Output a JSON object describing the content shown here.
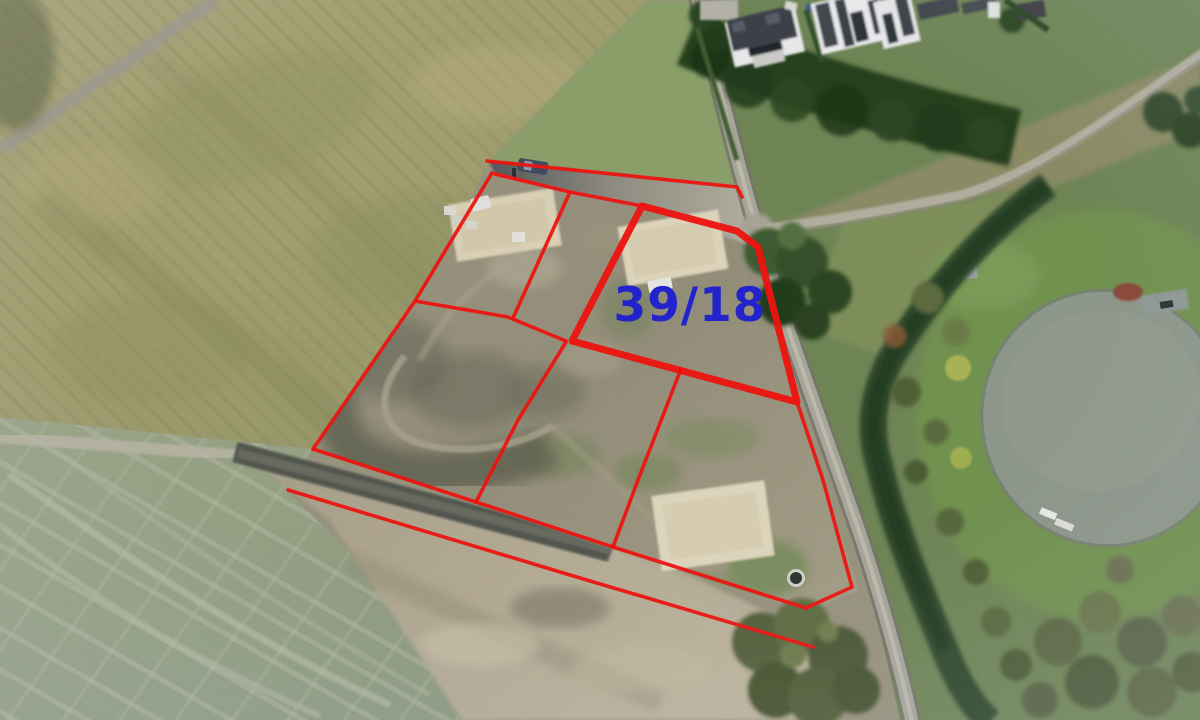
{
  "scene": {
    "kind": "aerial-drone-photo",
    "features": [
      "corn-field",
      "mowed-meadow",
      "building-plots",
      "excavation-pads",
      "access-roads",
      "houses",
      "conifer-row",
      "hedgerow",
      "pond",
      "large-trees",
      "parked-cars",
      "well-ring"
    ]
  },
  "annotation": {
    "parcel_label": "39/18",
    "label_color": "#2323cc",
    "label_center_x": 690,
    "label_center_y": 304,
    "label_font_size": 47,
    "line_color": "#ec1410",
    "thin_line_width": 3.6,
    "thick_line_width": 7,
    "parcel_39_18_outline": [
      [
        642,
        206
      ],
      [
        737,
        231
      ],
      [
        758,
        247
      ],
      [
        797,
        402
      ],
      [
        572,
        341
      ]
    ],
    "boundary_lines": [
      {
        "name": "north-boundary",
        "points": [
          [
            487,
            161
          ],
          [
            737,
            187
          ],
          [
            742,
            197
          ]
        ]
      },
      {
        "name": "west-boundary",
        "points": [
          [
            492,
            173
          ],
          [
            415,
            301
          ],
          [
            313,
            449
          ]
        ]
      },
      {
        "name": "road-south-edge",
        "points": [
          [
            495,
            174
          ],
          [
            570,
            192
          ],
          [
            642,
            206
          ]
        ]
      },
      {
        "name": "upper-divider",
        "points": [
          [
            570,
            192
          ],
          [
            513,
            318
          ]
        ]
      },
      {
        "name": "middle-cross-line",
        "points": [
          [
            415,
            301
          ],
          [
            508,
            317
          ],
          [
            566,
            341
          ]
        ]
      },
      {
        "name": "lower-west-divider",
        "points": [
          [
            566,
            342
          ],
          [
            518,
            420
          ],
          [
            476,
            502
          ]
        ]
      },
      {
        "name": "south-boundary",
        "points": [
          [
            313,
            449
          ],
          [
            476,
            502
          ],
          [
            613,
            547
          ],
          [
            806,
            608
          ]
        ]
      },
      {
        "name": "lower-middle-divider",
        "points": [
          [
            681,
            369
          ],
          [
            638,
            480
          ],
          [
            613,
            547
          ]
        ]
      },
      {
        "name": "east-boundary",
        "points": [
          [
            797,
            402
          ],
          [
            823,
            480
          ],
          [
            852,
            587
          ],
          [
            806,
            608
          ]
        ]
      },
      {
        "name": "road-reserve-line",
        "points": [
          [
            288,
            490
          ],
          [
            580,
            578
          ],
          [
            813,
            647
          ]
        ]
      }
    ]
  }
}
